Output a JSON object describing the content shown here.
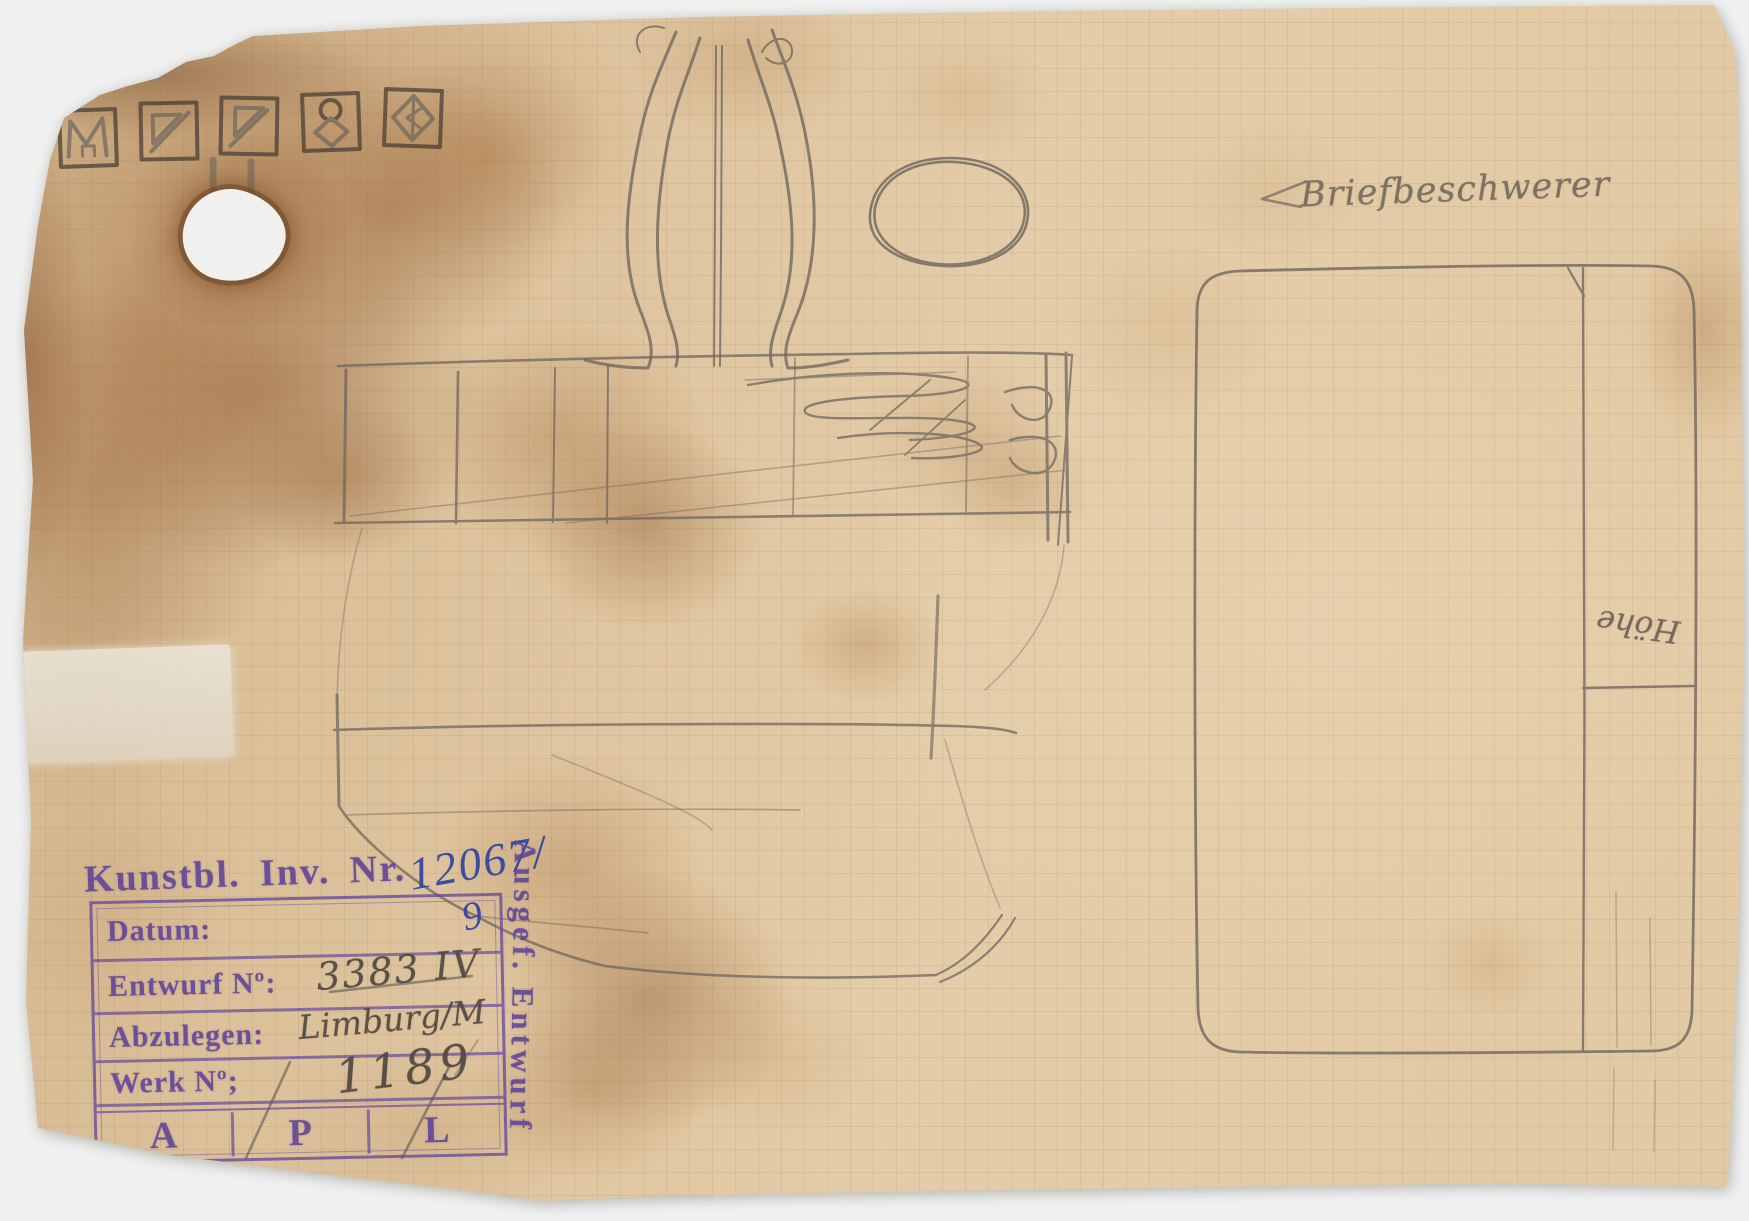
{
  "colors": {
    "stamp_violet": "#614698",
    "ink_blue": "#3446a0",
    "pencil": "#6e675f",
    "stamp_ink_dark": "#453c33",
    "paper": "#dfc49d"
  },
  "pencil_annotations": {
    "title": "Briefbeschwerer",
    "dimension_note": "Höhe",
    "entwurf_no": "3383 IV",
    "abzulegen_value": "Limburg/M",
    "werk_no_value": "1189"
  },
  "inventory_stamp": {
    "label": "Kunstbl. Inv. Nr.",
    "number_main": "12067/",
    "number_sub": "9"
  },
  "office_stamp": {
    "row_datum_label": "Datum:",
    "row_entwurf_label": "Entwurf Nº:",
    "row_abzulegen_label": "Abzulegen:",
    "row_werk_label": "Werk Nº;",
    "cells": [
      "A",
      "P",
      "L"
    ]
  },
  "side_stamp": {
    "text": "Ausgef. Entwurf"
  },
  "maker_marks": {
    "items": [
      "monogram-m",
      "triangle-diagonal",
      "triangle-diagonal",
      "circle-diamond-figure",
      "diamond-arrow"
    ]
  }
}
